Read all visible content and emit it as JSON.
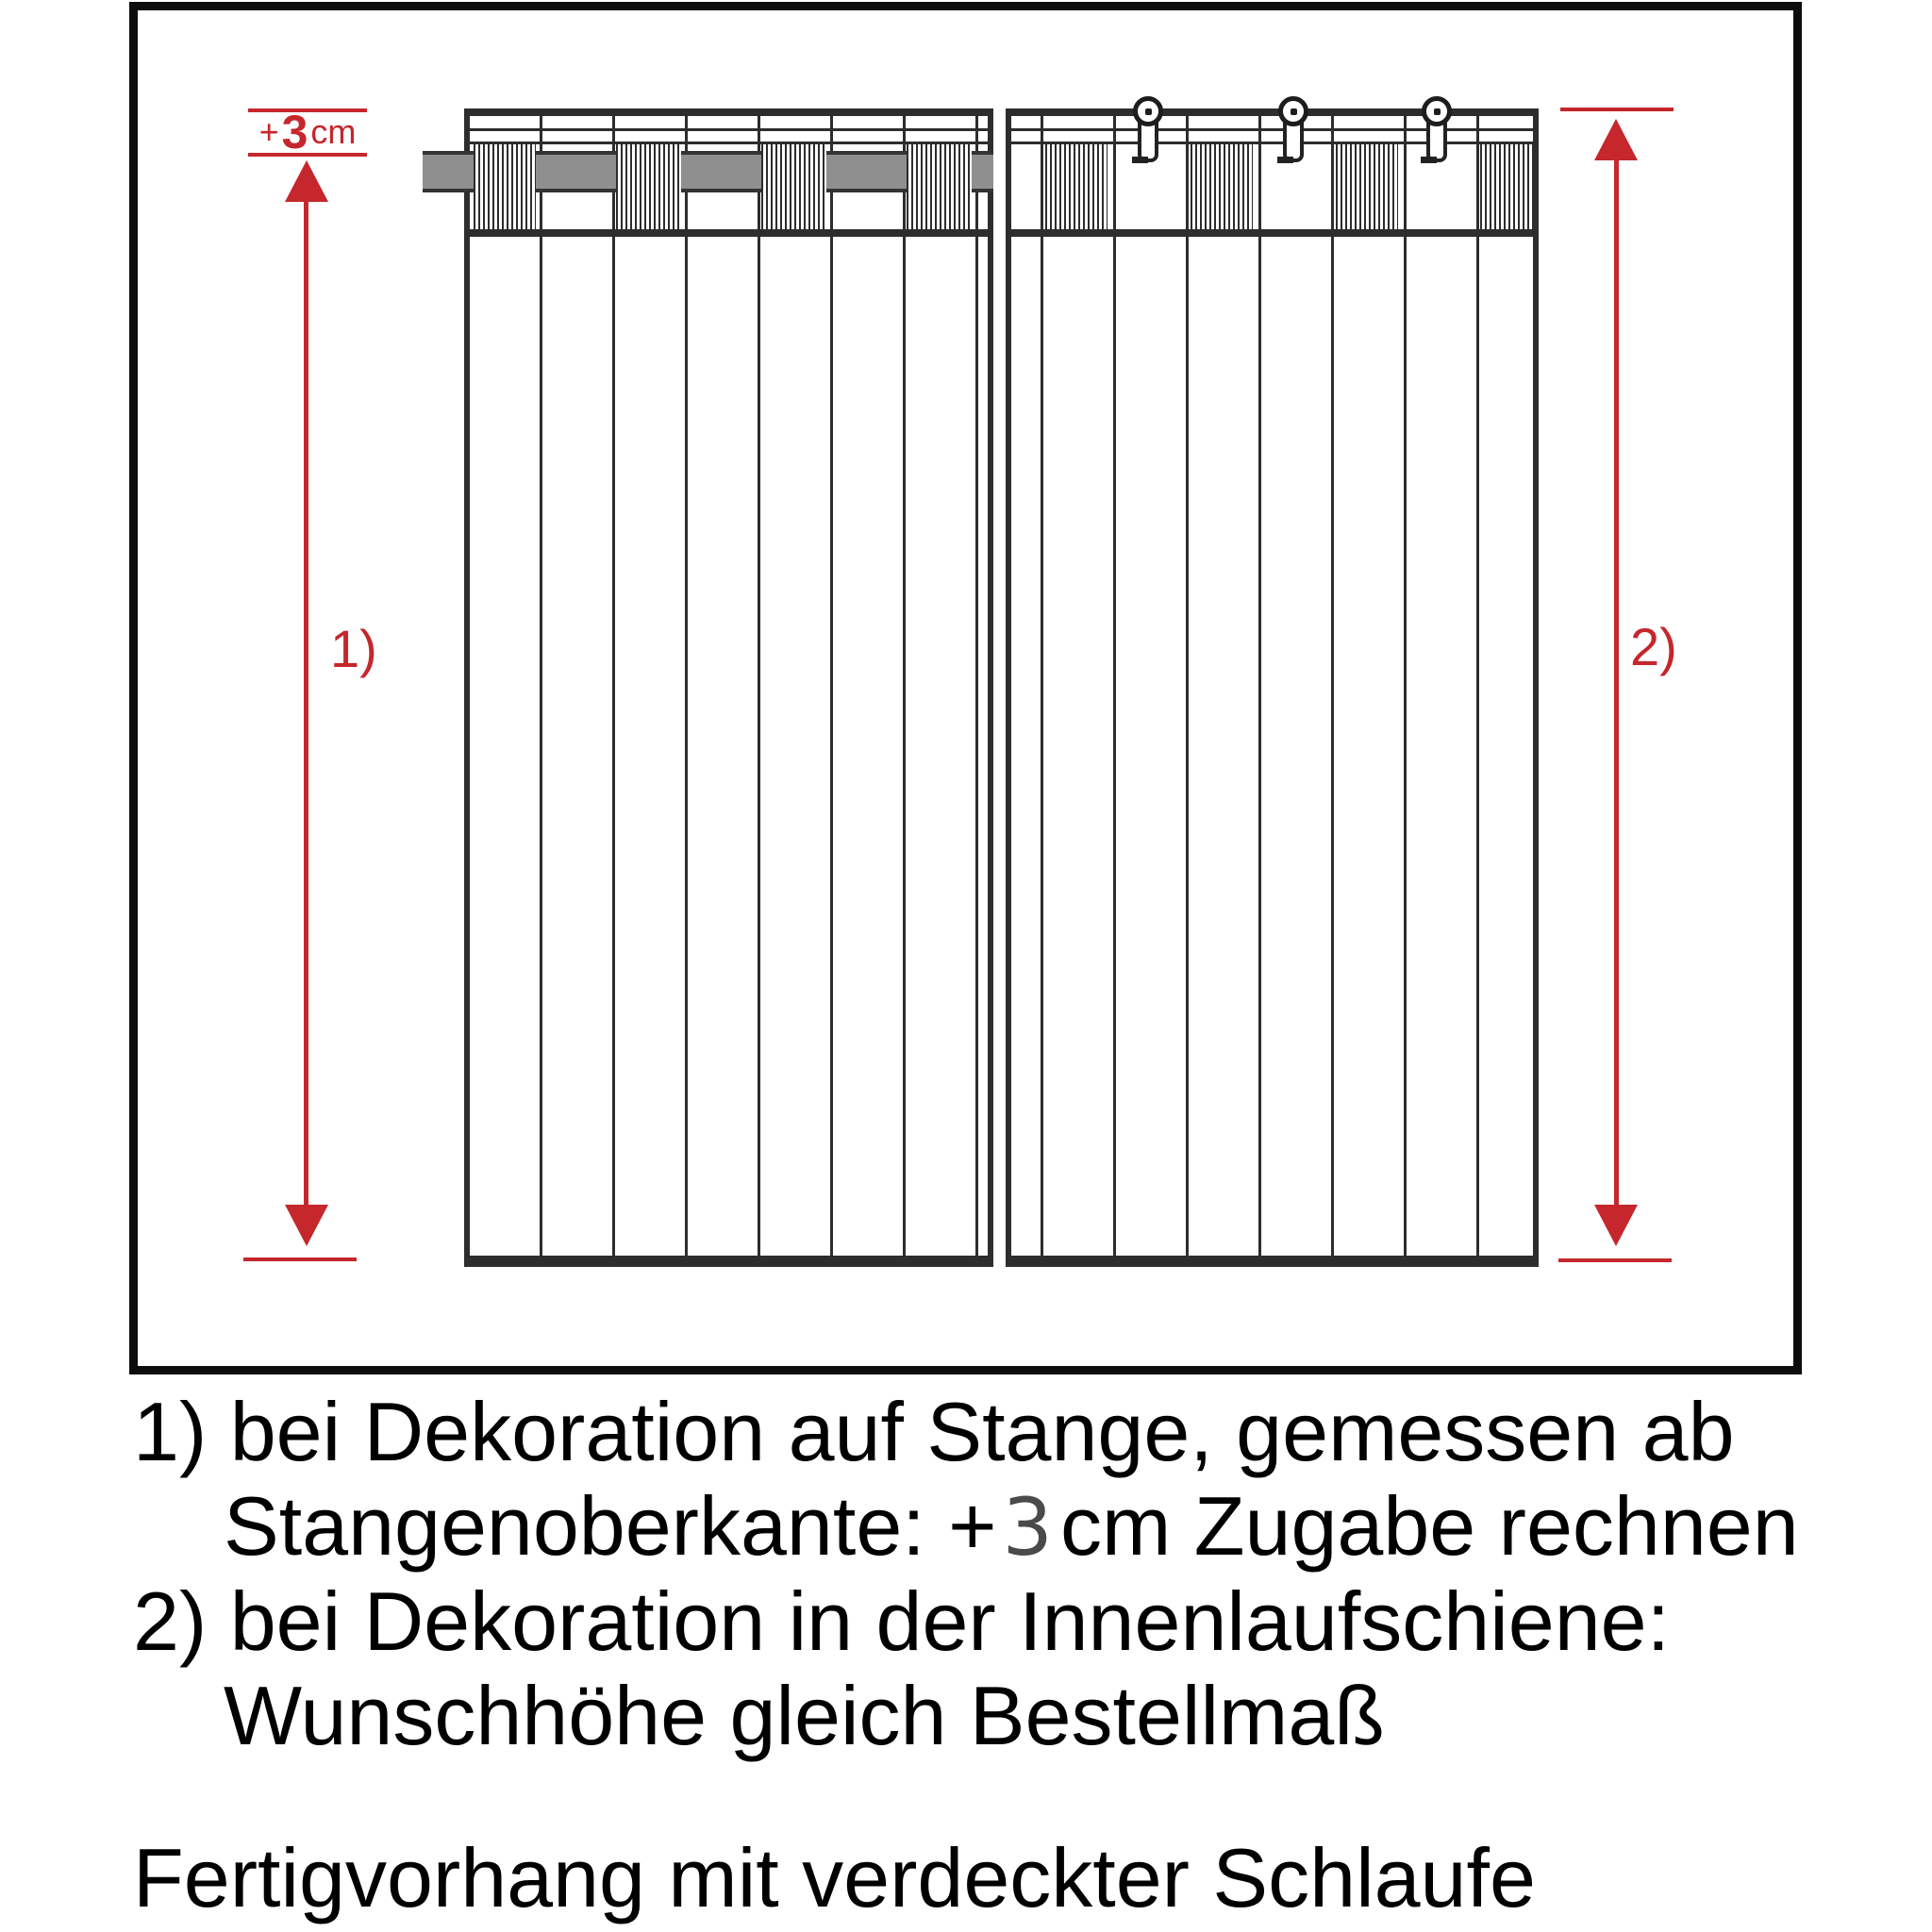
{
  "figure": {
    "allowance_label": {
      "plus": "+",
      "value": "3",
      "unit": "cm"
    },
    "arrow1_label": "1)",
    "arrow2_label": "2)"
  },
  "notes": {
    "line1": "1) bei Dekoration auf Stange, gemessen ab",
    "line2_prefix": "Stangenoberkante: +",
    "line2_value": "3",
    "line2_suffix": "cm Zugabe rechnen",
    "line3": "2) bei Dekoration in der Innenlaufschiene:",
    "line4": "Wunschhöhe gleich Bestellmaß",
    "line5": "Fertigvorhang mit verdeckter Schlaufe"
  },
  "colors": {
    "accent_red": "#c5272c",
    "line_dark": "#2d2d2d",
    "rod_gray": "#8f8f8f",
    "frame_black": "#0c0c0c"
  }
}
